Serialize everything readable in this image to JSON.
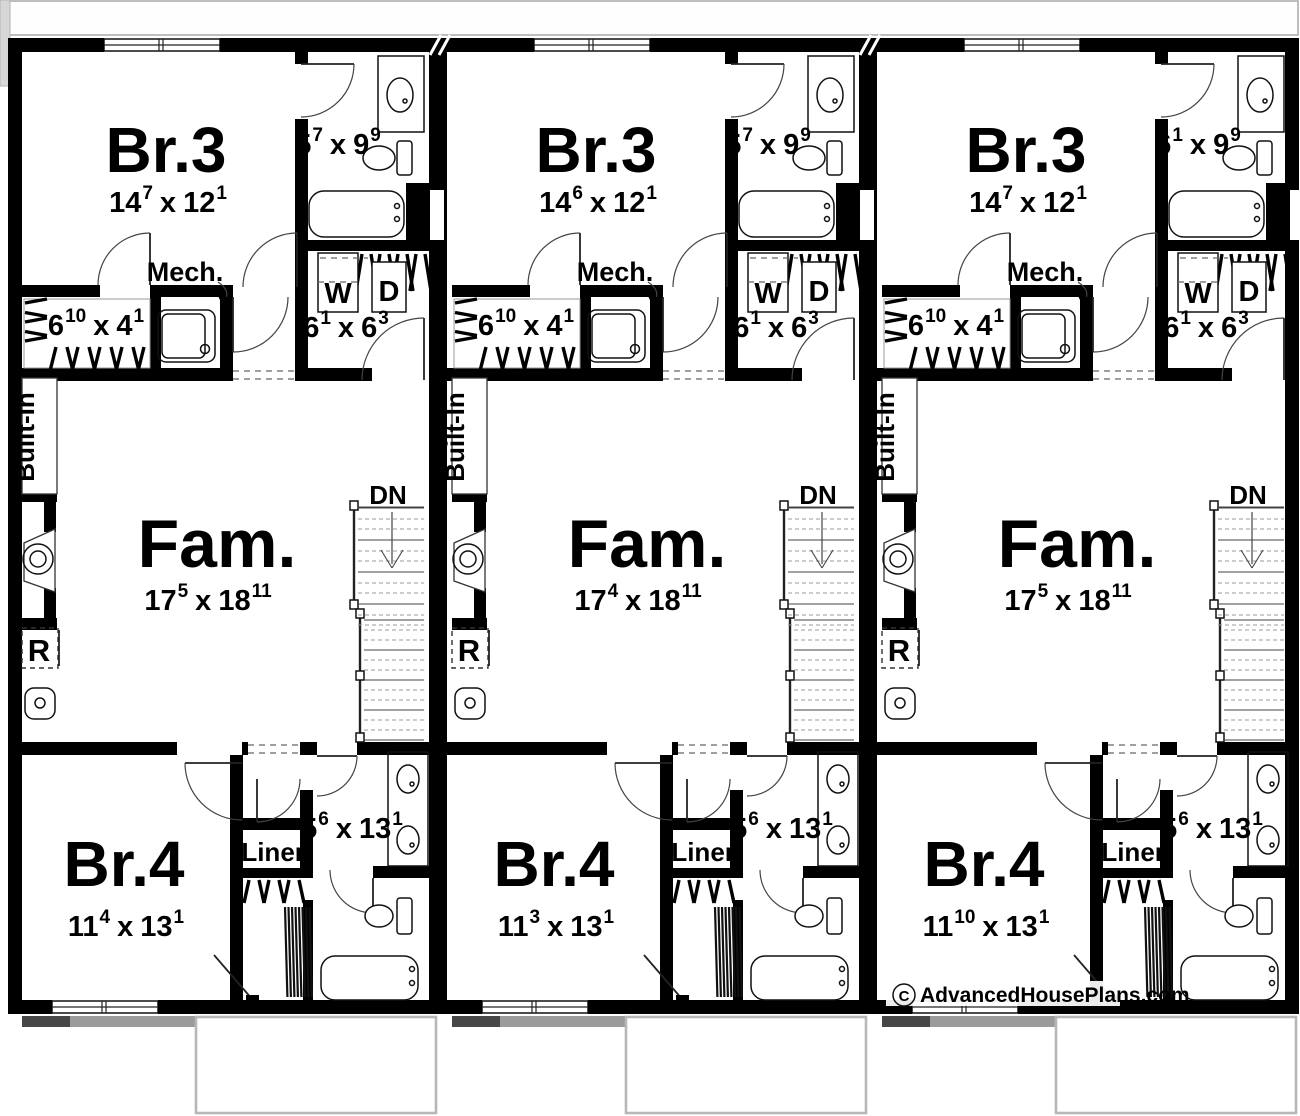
{
  "colors": {
    "wall": "#000000",
    "background": "#ffffff",
    "patio_border": "#b7b7b7",
    "step_band_dark": "#474747",
    "step_band_gray": "#9b9b9b",
    "corner_artifact": "#d7d7d7",
    "top_strip_border": "#a9a9a9"
  },
  "labels": {
    "dn": "DN",
    "mech": "Mech.",
    "built_in": "Built-In",
    "fridge": "R",
    "washer": "W",
    "dryer": "D",
    "linen": "Linen",
    "times": "x"
  },
  "watermark": {
    "symbol": "C",
    "text": "AdvancedHousePlans.com"
  },
  "units": [
    {
      "br3": {
        "name": "Br.3",
        "dim": {
          "a": "14",
          "sa": "7",
          "b": "12",
          "sb": "1"
        }
      },
      "bath_upper_dim": {
        "a": "5",
        "sa": "7",
        "b": "9",
        "sb": "9"
      },
      "closet_dim": {
        "a": "6",
        "sa": "10",
        "b": "4",
        "sb": "1"
      },
      "laundry_dim": {
        "a": "6",
        "sa": "1",
        "b": "6",
        "sb": "3"
      },
      "fam": {
        "name": "Fam.",
        "dim": {
          "a": "17",
          "sa": "5",
          "b": "18",
          "sb": "11"
        }
      },
      "br4": {
        "name": "Br.4",
        "dim": {
          "a": "11",
          "sa": "4",
          "b": "13",
          "sb": "1"
        }
      },
      "bath_lower_dim": {
        "a": "5",
        "sa": "6",
        "b": "13",
        "sb": "1"
      }
    },
    {
      "br3": {
        "name": "Br.3",
        "dim": {
          "a": "14",
          "sa": "6",
          "b": "12",
          "sb": "1"
        }
      },
      "bath_upper_dim": {
        "a": "5",
        "sa": "7",
        "b": "9",
        "sb": "9"
      },
      "closet_dim": {
        "a": "6",
        "sa": "10",
        "b": "4",
        "sb": "1"
      },
      "laundry_dim": {
        "a": "6",
        "sa": "1",
        "b": "6",
        "sb": "3"
      },
      "fam": {
        "name": "Fam.",
        "dim": {
          "a": "17",
          "sa": "4",
          "b": "18",
          "sb": "11"
        }
      },
      "br4": {
        "name": "Br.4",
        "dim": {
          "a": "11",
          "sa": "3",
          "b": "13",
          "sb": "1"
        }
      },
      "bath_lower_dim": {
        "a": "5",
        "sa": "6",
        "b": "13",
        "sb": "1"
      }
    },
    {
      "br3": {
        "name": "Br.3",
        "dim": {
          "a": "14",
          "sa": "7",
          "b": "12",
          "sb": "1"
        }
      },
      "bath_upper_dim": {
        "a": "6",
        "sa": "1",
        "b": "9",
        "sb": "9"
      },
      "closet_dim": {
        "a": "6",
        "sa": "10",
        "b": "4",
        "sb": "1"
      },
      "laundry_dim": {
        "a": "6",
        "sa": "1",
        "b": "6",
        "sb": "3"
      },
      "fam": {
        "name": "Fam.",
        "dim": {
          "a": "17",
          "sa": "5",
          "b": "18",
          "sb": "11"
        }
      },
      "br4": {
        "name": "Br.4",
        "dim": {
          "a": "11",
          "sa": "10",
          "b": "13",
          "sb": "1"
        }
      },
      "bath_lower_dim": {
        "a": "5",
        "sa": "6",
        "b": "13",
        "sb": "1"
      }
    }
  ]
}
